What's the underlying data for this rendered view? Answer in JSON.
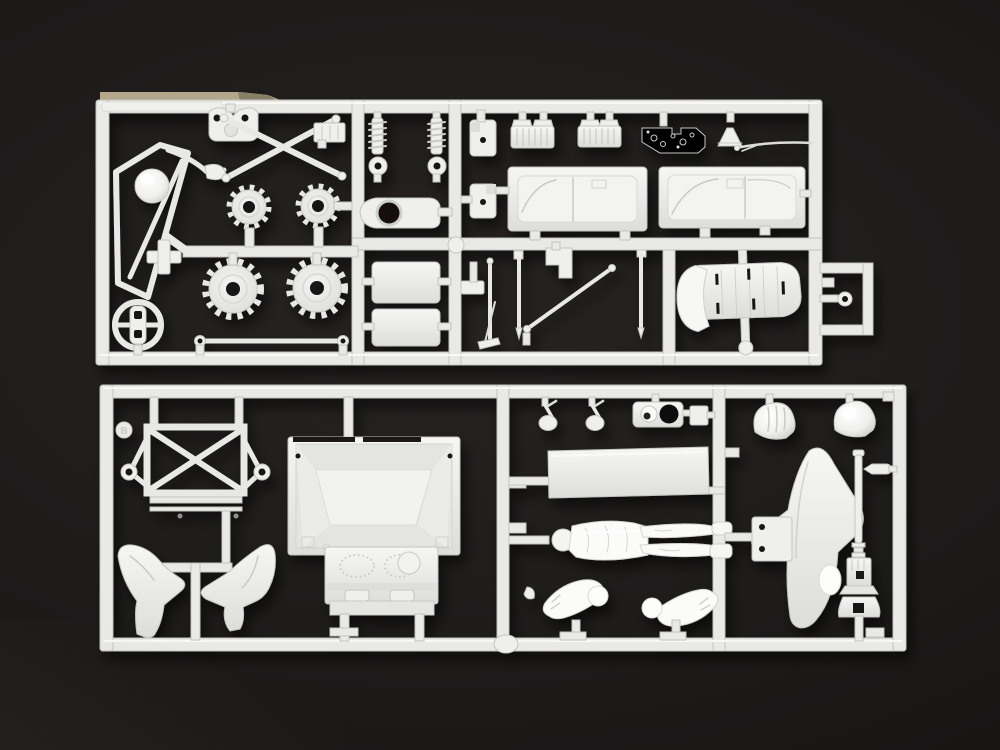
{
  "meta": {
    "description": "Top-down photograph of two white polystyrene model-kit sprues (injection-molded parts frames) laid on a black studio background",
    "sprue_count": 2
  },
  "colors": {
    "background": "#1e1c1b",
    "vignette": "#100f0e",
    "plastic": "#e9e9e6",
    "plastic_bright": "#f7f7f5",
    "plastic_shadow": "#bdbdba",
    "through_hole": "#141312",
    "tan_tab": "#b5a88c"
  },
  "sprues": [
    {
      "id": "upper-sprue",
      "marking": "",
      "parts": [
        "windshield-frame",
        "headlight-dome",
        "cross-bracket",
        "steering-wheel",
        "engine-mount",
        "crossed-tie-rods",
        "ribbed-box",
        "drive-sprocket-small-left",
        "drive-sprocket-small-right",
        "drive-sprocket-large-left",
        "drive-sprocket-large-right",
        "track-link-rod",
        "shock-absorber-left",
        "shock-absorber-right",
        "axle-arm",
        "flat-panel-upper",
        "flat-panel-lower",
        "hinge-bracket-upper",
        "hinge-bracket-lower",
        "radiator-grille-left",
        "radiator-grille-right",
        "instrument-plate",
        "horn-funnel",
        "antenna-rod",
        "body-side-panel-left",
        "body-side-panel-right",
        "wiper-rod",
        "pointed-rod",
        "step-bracket",
        "diagonal-brace",
        "support-rod",
        "bucket-seat",
        "towing-eyelet"
      ]
    },
    {
      "id": "lower-sprue",
      "marking": "B",
      "parts": [
        "x-brace-frame",
        "front-fender-left",
        "front-fender-right",
        "cargo-tub",
        "firewall-dashboard",
        "foot-pedal-left",
        "foot-pedal-right",
        "instrument-cluster",
        "junction-box",
        "helmet-ribbed",
        "floor-plate",
        "driver-figure",
        "figure-arm-left",
        "figure-arm-right",
        "side-fender-blade",
        "mount-bracket",
        "helmet-smooth",
        "jack-pedestal",
        "grip-handle",
        "small-hook"
      ]
    }
  ]
}
